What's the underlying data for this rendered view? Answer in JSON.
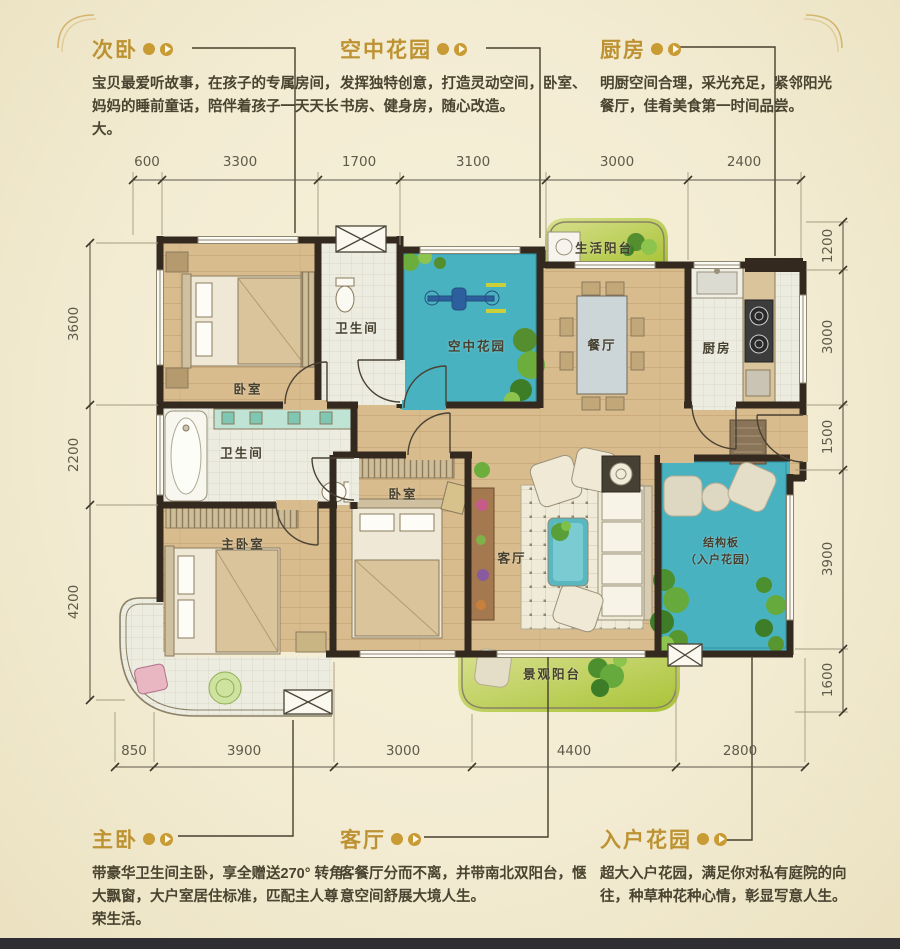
{
  "palette": {
    "background": "#f3ecd3",
    "accent_gold": "#bd9232",
    "wall": "#33291e",
    "water_teal": "#48b2c1",
    "balcony_green": "#b5c848",
    "wood": "#d9bc8e"
  },
  "annotations": {
    "top": [
      {
        "title": "次卧",
        "body": "宝贝最爱听故事，在孩子的专属房间，妈妈的睡前童话，陪伴着孩子一天天长大。"
      },
      {
        "title": "空中花园",
        "body": "发挥独特创意，打造灵动空间，卧室、书房、健身房，随心改造。"
      },
      {
        "title": "厨房",
        "body": "明厨空间合理，采光充足，紧邻阳光餐厅，佳肴美食第一时间品尝。"
      }
    ],
    "bottom": [
      {
        "title": "主卧",
        "body": "带豪华卫生间主卧，享全赠送270° 转角大飘窗，大户室居住标准，匹配主人尊荣生活。"
      },
      {
        "title": "客厅",
        "body": "客餐厅分而不离，并带南北双阳台，惬意空间舒展大境人生。"
      },
      {
        "title": "入户花园",
        "body": "超大入户花园，满足你对私有庭院的向往，种草种花种心情，彰显写意人生。"
      }
    ]
  },
  "dimensions": {
    "top": [
      "600",
      "3300",
      "1700",
      "3100",
      "3000",
      "2400"
    ],
    "bottom": [
      "850",
      "3900",
      "3000",
      "4400",
      "2800"
    ],
    "left": [
      "3600",
      "2200",
      "4200"
    ],
    "right": [
      "1200",
      "3000",
      "1500",
      "3900",
      "1600"
    ]
  },
  "rooms": {
    "bedroom_top": "卧室",
    "bathroom_top": "卫生间",
    "sky_garden": "空中花园",
    "life_balcony": "生活阳台",
    "dining_room": "餐厅",
    "kitchen": "厨房",
    "bathroom_master": "卫生间",
    "master_bedroom": "主卧室",
    "bedroom_middle": "卧室",
    "living_room": "客厅",
    "entry_garden_line1": "结构板",
    "entry_garden_line2": "（入户花园）",
    "view_balcony": "景观阳台"
  }
}
